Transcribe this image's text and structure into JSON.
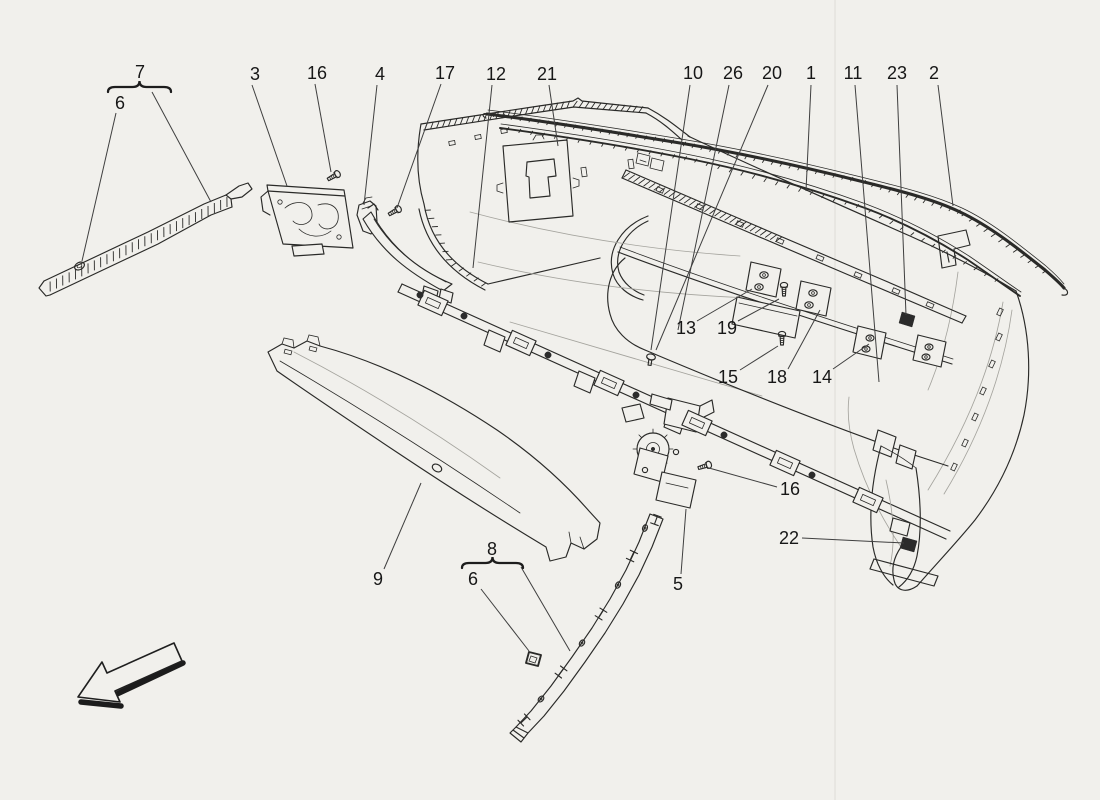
{
  "page": {
    "background": "#f1f0ec",
    "ink_color": "#2a2a28",
    "leader_color": "#3f3f3f",
    "label_color": "#171717",
    "label_font_size": 18
  },
  "diagram": {
    "figure_type": "exploded-parts-diagram",
    "direction_arrow": {
      "orientation": "down-left"
    },
    "parts_shown": [
      "1",
      "2",
      "3",
      "4",
      "5",
      "6",
      "7",
      "8",
      "9",
      "10",
      "11",
      "12",
      "13",
      "14",
      "15",
      "16",
      "17",
      "18",
      "19",
      "20",
      "21",
      "22",
      "23",
      "26"
    ],
    "callouts": [
      {
        "label": "7",
        "x": 140,
        "y": 72,
        "bracket": {
          "x1": 108,
          "x2": 171,
          "y": 87
        },
        "leader": [
          [
            152,
            92
          ],
          [
            211,
            202
          ]
        ]
      },
      {
        "label": "6",
        "x": 120,
        "y": 103,
        "leader": [
          [
            116,
            113
          ],
          [
            82,
            261
          ]
        ]
      },
      {
        "label": "3",
        "x": 255,
        "y": 74,
        "leader": [
          [
            252,
            85
          ],
          [
            287,
            186
          ]
        ]
      },
      {
        "label": "16",
        "x": 317,
        "y": 73,
        "leader": [
          [
            315,
            84
          ],
          [
            331,
            172
          ]
        ]
      },
      {
        "label": "4",
        "x": 380,
        "y": 74,
        "leader": [
          [
            377,
            85
          ],
          [
            364,
            205
          ]
        ]
      },
      {
        "label": "17",
        "x": 445,
        "y": 73,
        "leader": [
          [
            441,
            84
          ],
          [
            397,
            208
          ]
        ]
      },
      {
        "label": "12",
        "x": 496,
        "y": 74,
        "leader": [
          [
            492,
            85
          ],
          [
            473,
            268
          ]
        ]
      },
      {
        "label": "21",
        "x": 547,
        "y": 74,
        "leader": [
          [
            549,
            85
          ],
          [
            558,
            146
          ]
        ]
      },
      {
        "label": "10",
        "x": 693,
        "y": 73,
        "leader": [
          [
            690,
            85
          ],
          [
            651,
            350
          ]
        ]
      },
      {
        "label": "26",
        "x": 733,
        "y": 73,
        "leader": [
          [
            729,
            85
          ],
          [
            678,
            330
          ]
        ]
      },
      {
        "label": "20",
        "x": 772,
        "y": 73,
        "leader": [
          [
            768,
            85
          ],
          [
            656,
            350
          ]
        ]
      },
      {
        "label": "1",
        "x": 811,
        "y": 73,
        "leader": [
          [
            811,
            85
          ],
          [
            806,
            191
          ]
        ]
      },
      {
        "label": "11",
        "x": 853,
        "y": 73,
        "leader": [
          [
            855,
            85
          ],
          [
            879,
            382
          ]
        ]
      },
      {
        "label": "23",
        "x": 897,
        "y": 73,
        "leader": [
          [
            897,
            85
          ],
          [
            906,
            315
          ]
        ]
      },
      {
        "label": "2",
        "x": 934,
        "y": 73,
        "leader": [
          [
            938,
            85
          ],
          [
            953,
            206
          ]
        ]
      },
      {
        "label": "13",
        "x": 686,
        "y": 328,
        "leader": [
          [
            697,
            321
          ],
          [
            752,
            289
          ]
        ]
      },
      {
        "label": "19",
        "x": 727,
        "y": 328,
        "leader": [
          [
            738,
            321
          ],
          [
            779,
            299
          ]
        ]
      },
      {
        "label": "15",
        "x": 728,
        "y": 377,
        "leader": [
          [
            740,
            370
          ],
          [
            778,
            346
          ]
        ]
      },
      {
        "label": "18",
        "x": 777,
        "y": 377,
        "leader": [
          [
            788,
            369
          ],
          [
            820,
            310
          ]
        ]
      },
      {
        "label": "14",
        "x": 822,
        "y": 377,
        "leader": [
          [
            833,
            369
          ],
          [
            869,
            344
          ]
        ]
      },
      {
        "label": "16",
        "x": 790,
        "y": 489,
        "leader": [
          [
            777,
            487
          ],
          [
            709,
            468
          ]
        ]
      },
      {
        "label": "22",
        "x": 789,
        "y": 538,
        "leader": [
          [
            802,
            538
          ],
          [
            904,
            543
          ]
        ]
      },
      {
        "label": "5",
        "x": 678,
        "y": 584,
        "leader": [
          [
            681,
            574
          ],
          [
            686,
            509
          ]
        ]
      },
      {
        "label": "9",
        "x": 378,
        "y": 579,
        "leader": [
          [
            384,
            569
          ],
          [
            421,
            483
          ]
        ]
      },
      {
        "label": "8",
        "x": 492,
        "y": 549,
        "bracket": {
          "x1": 462,
          "x2": 523,
          "y": 563
        },
        "leader": [
          [
            521,
            567
          ],
          [
            570,
            651
          ]
        ]
      },
      {
        "label": "6",
        "x": 473,
        "y": 579,
        "leader": [
          [
            481,
            589
          ],
          [
            529,
            651
          ]
        ]
      }
    ]
  }
}
